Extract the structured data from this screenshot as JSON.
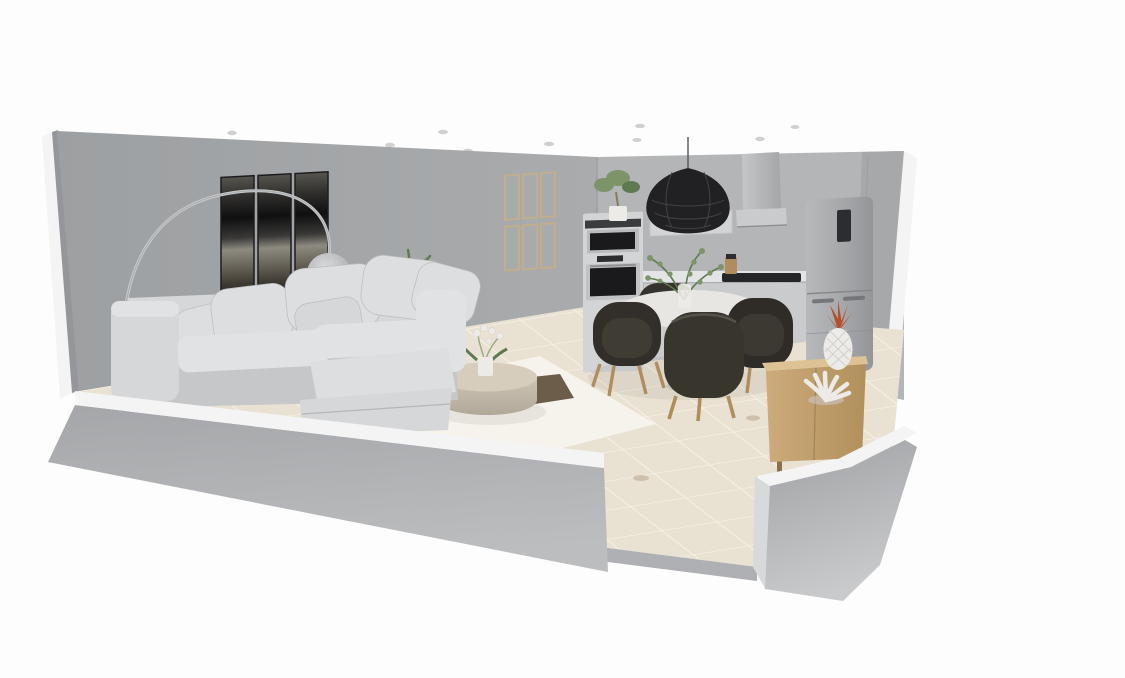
{
  "canvas": {
    "width": 1125,
    "height": 678
  },
  "scene": {
    "title": "3D cutaway dollhouse render of an open-plan living room, dining area and kitchen",
    "view": "dollhouse cutaway perspective, white background",
    "rooms": [
      "living-room",
      "dining-area",
      "kitchen"
    ]
  },
  "palette": {
    "bg": "#fdfdfd",
    "wall_living": "#a6a8aa",
    "wall_living_dark": "#9a9c9f",
    "wall_kitchen": "#b3b5b7",
    "wall_side": "#94969a",
    "cut_edge": "#f4f4f5",
    "floor": "#e9e1d2",
    "floor_grout": "#f7f2e8",
    "floor_stain": "#b7a88f",
    "gap_band": "#aeb0b3",
    "rug": "#f6f3ec",
    "rug_beige": "#d8c9ae",
    "rug_patch": "#53422f",
    "sofa": "#d6d7d9",
    "sofa_light": "#e1e2e4",
    "sofa_dark": "#c6c7c9",
    "pillow": "#dcdee0",
    "art_frame": "#1d1d1f",
    "frame_wood": "#c2ae8b",
    "steel": "#d2d4d6",
    "appliance_window": "#1a1a1c",
    "fridge_panel": "#2b2d30",
    "counter": "#e3e4e6",
    "cabinet": "#c9cbcd",
    "cooktop": "#242628",
    "hood": "#b8babc",
    "pendant": "#212124",
    "chair": "#322f2b",
    "wood_leg": "#b08d5f",
    "table_top": "#e8e6e2",
    "table_base": "#c6c4c0",
    "plant": "#7d9469",
    "plant_dark": "#5f7a50",
    "sideboard": "#c9a877",
    "sideboard_light": "#dcc294",
    "pineapple_leaf": "#b5502f",
    "decor_white": "#edebe7",
    "ceiling_dot": "#cfd0d2",
    "shade_glass": "#c3c5c8"
  },
  "counts": {
    "ceiling_spotlights": 11,
    "art_panels": 3,
    "wall_frames": 6,
    "sofa_pillows": 6,
    "dining_chairs": 4,
    "floor_stains": 3
  },
  "objects": [
    {
      "id": "left-wall",
      "label": "Left cutaway wall",
      "room": "living-room"
    },
    {
      "id": "back-wall-living",
      "label": "Living room back wall",
      "room": "living-room"
    },
    {
      "id": "back-wall-kitchen",
      "label": "Kitchen back wall",
      "room": "kitchen"
    },
    {
      "id": "right-wall",
      "label": "Right cutaway wall",
      "room": "kitchen"
    },
    {
      "id": "front-wall-left",
      "label": "Front cutaway pony wall (left)",
      "room": "living-room"
    },
    {
      "id": "front-wall-right",
      "label": "Front cutaway pony wall (right)",
      "room": "kitchen"
    },
    {
      "id": "door-opening",
      "label": "Door opening in front wall",
      "room": "dining-area"
    },
    {
      "id": "tiled-floor",
      "label": "Beige tiled floor",
      "room": "all"
    },
    {
      "id": "ceiling-spotlights",
      "label": "Recessed ceiling spotlights",
      "room": "all"
    },
    {
      "id": "wall-art-triptych",
      "label": "Dark abstract triptych wall art",
      "room": "living-room"
    },
    {
      "id": "wall-frame-grid",
      "label": "Grid of six beige wall frames",
      "room": "living-room"
    },
    {
      "id": "arc-floor-lamp",
      "label": "Chrome arc floor lamp with glass shade",
      "room": "living-room"
    },
    {
      "id": "sectional-sofa",
      "label": "Light grey sectional sofa with chaise and cushions",
      "room": "living-room"
    },
    {
      "id": "area-rug",
      "label": "Cream area rug",
      "room": "living-room"
    },
    {
      "id": "rug-dark-patch",
      "label": "Dark brown patch on rug",
      "room": "living-room"
    },
    {
      "id": "coffee-table",
      "label": "Round drum coffee table",
      "room": "living-room"
    },
    {
      "id": "orchid-plant",
      "label": "White potted orchid",
      "room": "living-room"
    },
    {
      "id": "palm-plant",
      "label": "Potted palm plant",
      "room": "living-room"
    },
    {
      "id": "dining-table",
      "label": "Round white pedestal dining table",
      "room": "dining-area"
    },
    {
      "id": "table-vase",
      "label": "Vase with eucalyptus branches",
      "room": "dining-area"
    },
    {
      "id": "dining-chair",
      "label": "Dark upholstered dining chair with wood legs",
      "room": "dining-area"
    },
    {
      "id": "pendant-lamp",
      "label": "Black woven pendant lamp",
      "room": "dining-area"
    },
    {
      "id": "oven-column",
      "label": "Tall oven column with microwave and oven",
      "room": "kitchen"
    },
    {
      "id": "plant-on-oven",
      "label": "Small plant on oven column",
      "room": "kitchen"
    },
    {
      "id": "kitchen-counter",
      "label": "Kitchen counter with base cabinets",
      "room": "kitchen"
    },
    {
      "id": "cooktop",
      "label": "Black cooktop",
      "room": "kitchen"
    },
    {
      "id": "knife-block",
      "label": "Wooden knife block",
      "room": "kitchen"
    },
    {
      "id": "range-hood",
      "label": "Chimney range hood",
      "room": "kitchen"
    },
    {
      "id": "wall-niche-panel",
      "label": "Recessed wall panel",
      "room": "kitchen"
    },
    {
      "id": "fridge-freezer",
      "label": "Grey fridge freezer",
      "room": "kitchen"
    },
    {
      "id": "sideboard",
      "label": "Light oak sideboard",
      "room": "dining-area"
    },
    {
      "id": "pineapple-ornament",
      "label": "White pineapple ornament with copper leaves",
      "room": "dining-area"
    },
    {
      "id": "coral-ornament",
      "label": "White coral ornament",
      "room": "dining-area"
    }
  ]
}
